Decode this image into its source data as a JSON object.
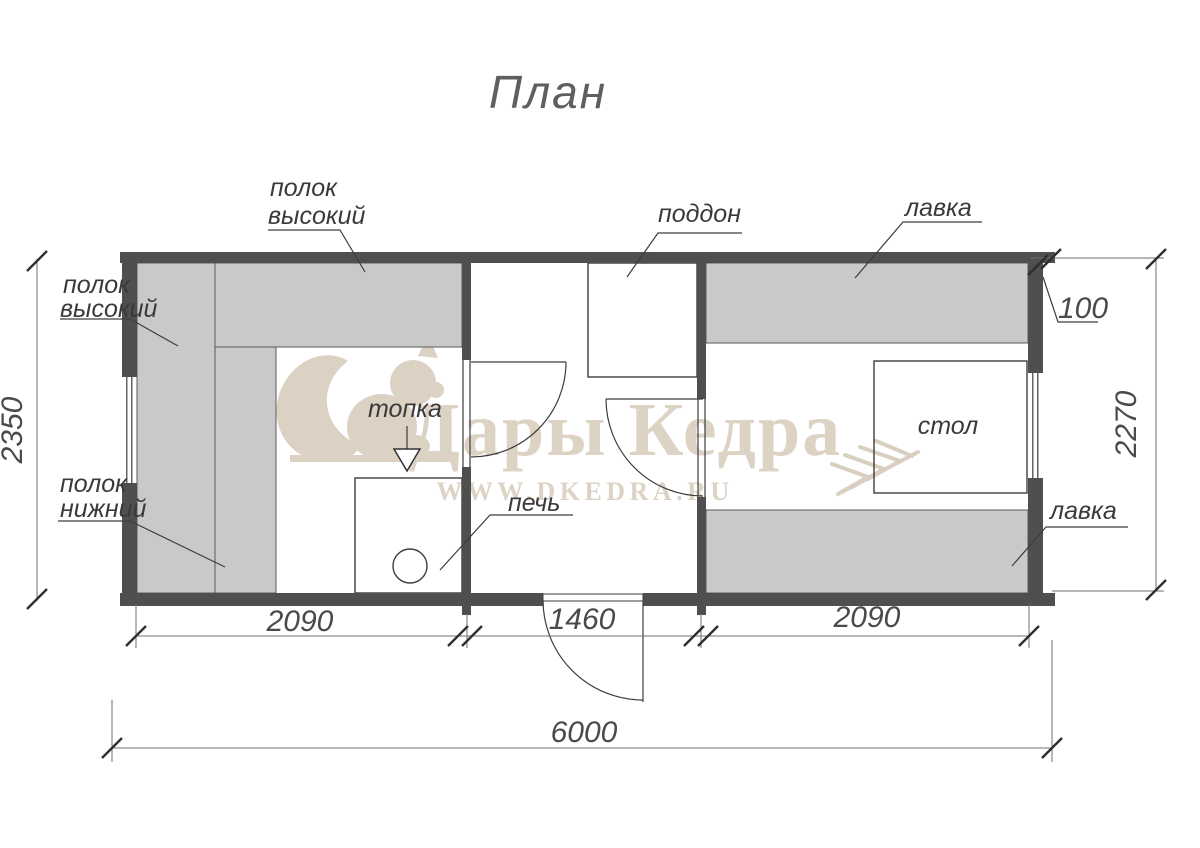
{
  "title": "План",
  "watermark": {
    "brand": "Дары Кедра",
    "site": "WWW.DKEDRA.RU"
  },
  "labels": {
    "shelf_high_top": {
      "l1": "полок",
      "l2": "высокий"
    },
    "shelf_high_left": {
      "l1": "полок",
      "l2": "высокий"
    },
    "shelf_low": {
      "l1": "полок",
      "l2": "нижний"
    },
    "firebox": "топка",
    "stove": "печь",
    "tray": "поддон",
    "bench_top": "лавка",
    "bench_bottom": "лавка",
    "table": "стол"
  },
  "dimensions": {
    "room1_width": "2090",
    "shower_width": "1460",
    "room2_width": "2090",
    "total_width": "6000",
    "left_depth": "2350",
    "right_depth": "2270",
    "wall_thickness": "100"
  },
  "colors": {
    "wall": "#4f4f4f",
    "shelf_fill": "#c9c9c9",
    "drawing_line": "#3d3d3d",
    "watermark": "#dcd2c4"
  }
}
